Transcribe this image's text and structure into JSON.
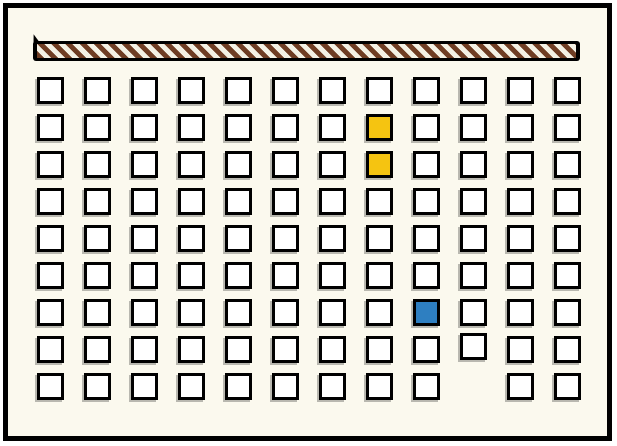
{
  "board": {
    "rows": 9,
    "cols": 12,
    "cells": {
      "yellow": [
        {
          "row": 2,
          "col": 8
        },
        {
          "row": 3,
          "col": 8
        }
      ],
      "blue": [
        {
          "row": 7,
          "col": 9
        }
      ],
      "missing": [
        {
          "row": 9,
          "col": 10
        }
      ],
      "raised": [
        {
          "row": 8,
          "col": 10,
          "dy": -3
        }
      ]
    }
  },
  "bar": {
    "style": "diagonal-stripes",
    "stripe_direction": "backslash"
  },
  "colors": {
    "page_bg": "#ffffff",
    "frame": "#000000",
    "board_bg": "#fbf9ee",
    "tile_fill": "#ffffff",
    "tile_border": "#000000",
    "tile_shadow": "#b9b8b0",
    "yellow": "#f5c411",
    "blue": "#2e7fc1",
    "stripe_brown": "#6f3d23",
    "stripe_white": "#f4f1e4",
    "bar_outline": "#000000"
  }
}
